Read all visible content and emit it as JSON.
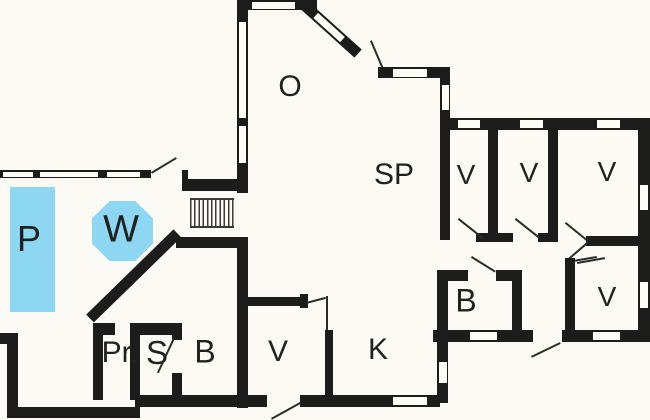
{
  "plan": {
    "type": "floor-plan",
    "colors": {
      "background": "#fbfaf5",
      "walls": "#1c1c1a",
      "water": "#8dd7f3",
      "text": "#21211f"
    },
    "rooms": {
      "pool": {
        "label": "P"
      },
      "whirlpool": {
        "label": "W"
      },
      "living": {
        "label": "O"
      },
      "dining": {
        "label": "SP"
      },
      "bedroom1": {
        "label": "V"
      },
      "bedroom2": {
        "label": "V"
      },
      "bedroom3": {
        "label": "V"
      },
      "bedroom4": {
        "label": "V"
      },
      "bath_right": {
        "label": "B"
      },
      "kitchen": {
        "label": "K"
      },
      "entry": {
        "label": "V"
      },
      "pr_room": {
        "label": "Pr."
      },
      "sauna": {
        "label": "S"
      },
      "bath_left": {
        "label": "B"
      }
    }
  }
}
